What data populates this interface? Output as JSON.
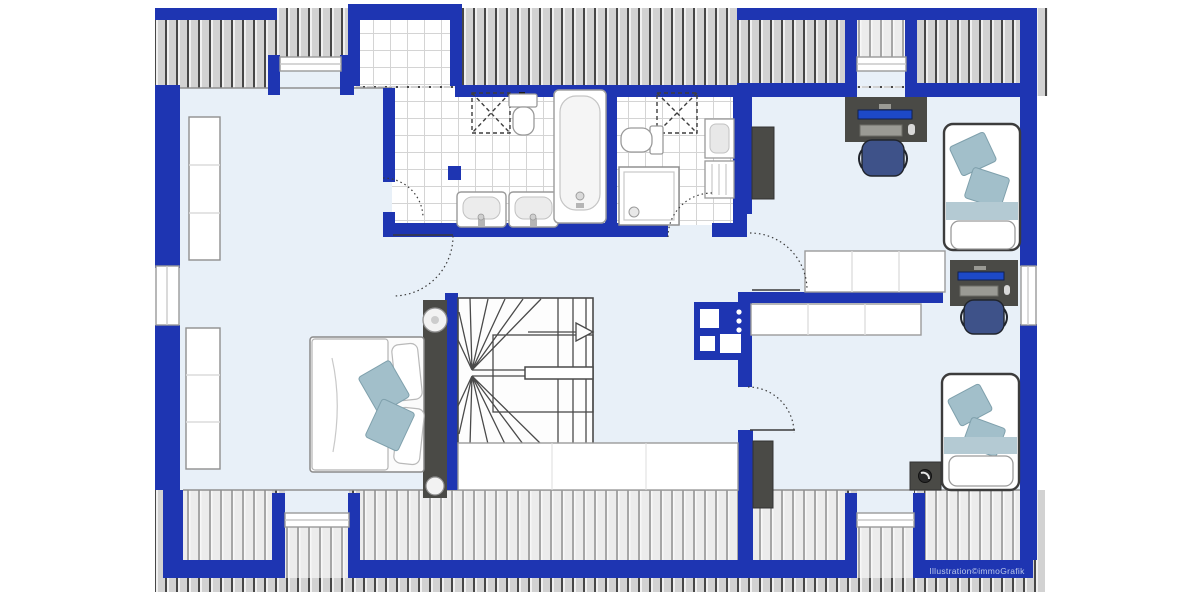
{
  "illustration": {
    "credit": "Illustration©immoGrafik",
    "type": "attic floor plan"
  },
  "colors": {
    "page_bg": "#ffffff",
    "wall": "#1e35b2",
    "floor": "#e8f0f8",
    "roof_base": "#d2d2d2",
    "roof_stripe": "#474747",
    "roof_light_base": "#ececec",
    "roof_light_stripe": "#a6a6a6",
    "tile_line": "#d4d4d4",
    "furniture_dark": "#4a4a46",
    "furniture_white": "#ffffff",
    "furniture_outline": "#979797",
    "screen_blue": "#1d49c7",
    "chair_blue": "#3e5289",
    "pillow_blue": "#a2bfca",
    "bed_band": "#b4cad3",
    "stair_line": "#4a4a4a",
    "credit_color": "#bac7e9"
  },
  "rooms": {
    "left_bedroom": {
      "fixtures": [
        "double-bed",
        "wardrobe",
        "wardrobe",
        "bedside-panel-with-lamps",
        "dormer-window-top",
        "window-left",
        "dormer-window-bottom"
      ]
    },
    "bathroom_main": {
      "fixtures": [
        "bathtub",
        "washbasin",
        "washbasin",
        "toilet",
        "washing-machine-dashed",
        "dormer-skylight"
      ]
    },
    "bathroom_small": {
      "fixtures": [
        "shower",
        "toilet",
        "wall-basin",
        "radiator",
        "washing-machine-dashed"
      ]
    },
    "hall": {
      "fixtures": [
        "winder-staircase",
        "stair-direction-arrow",
        "kitchenette-unit",
        "sideboard",
        "sideboard",
        "balustrade-cabinet"
      ]
    },
    "bedroom_top_right": {
      "fixtures": [
        "desk",
        "office-chair",
        "single-bed",
        "tall-cabinet",
        "dormer-window-top"
      ]
    },
    "bedroom_bottom_right": {
      "fixtures": [
        "desk",
        "office-chair",
        "single-bed",
        "nightstand-with-lamp",
        "tall-cabinet",
        "window-right",
        "dormer-window-bottom"
      ]
    }
  },
  "counts": {
    "windows": 6,
    "door_swings": 5,
    "washing_machines": 2
  }
}
